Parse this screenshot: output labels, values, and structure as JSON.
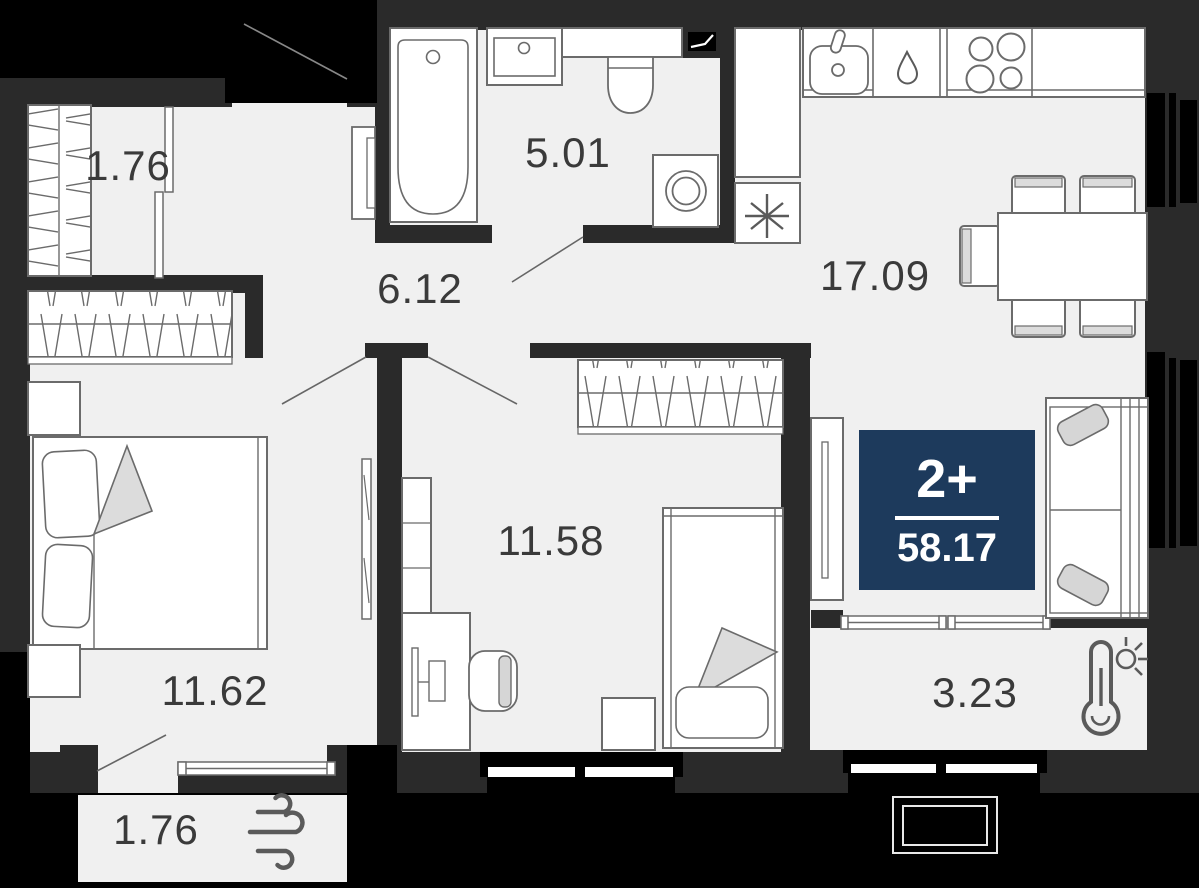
{
  "plan": {
    "title": "apartment-floor-plan",
    "badge": {
      "rooms_label": "2+",
      "total_area": "58.17",
      "bg_color": "#1d3a5c",
      "text_color": "#ffffff"
    },
    "rooms": [
      {
        "id": "closet-top",
        "area": "1.76"
      },
      {
        "id": "bathroom",
        "area": "5.01"
      },
      {
        "id": "hallway",
        "area": "6.12"
      },
      {
        "id": "kitchen-living",
        "area": "17.09"
      },
      {
        "id": "bedroom-small",
        "area": "11.58"
      },
      {
        "id": "bedroom-large",
        "area": "11.62"
      },
      {
        "id": "balcony-warm",
        "area": "3.23"
      },
      {
        "id": "balcony-bottom",
        "area": "1.76"
      }
    ],
    "icons": [
      "thermometer-sun-icon",
      "wind-icon",
      "ventilation-fan-icon",
      "vent-shaft-icon"
    ],
    "colors": {
      "floor": "#f0f0f0",
      "wall": "#2a2a2a",
      "exterior_black": "#000000",
      "furniture_stroke": "#6b6b6b",
      "soft_fill": "#dcdcdc",
      "label_text": "#3a3a3a"
    }
  }
}
